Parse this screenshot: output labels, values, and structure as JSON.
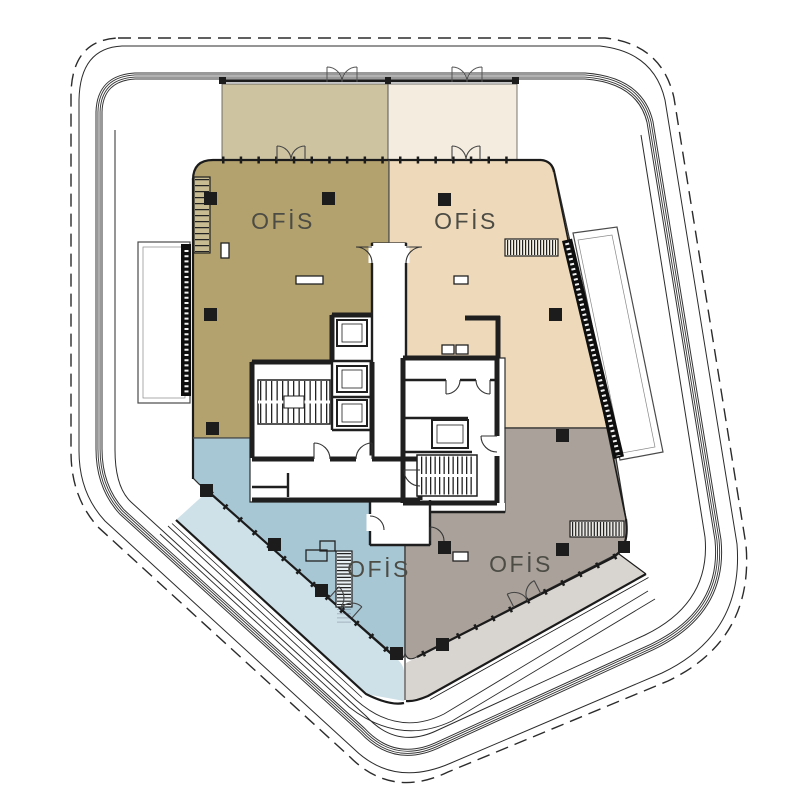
{
  "plan": {
    "zones": [
      {
        "name": "office-northwest",
        "label": "OFİS",
        "fill": "#b3a26e",
        "terrace_fill": "#cdc3a1"
      },
      {
        "name": "office-northeast",
        "label": "OFİS",
        "fill": "#eedabb",
        "terrace_fill": "#f4ecdf"
      },
      {
        "name": "office-southwest",
        "label": "OFİS",
        "fill": "#a8c7d5",
        "terrace_fill": "#cfe1e8"
      },
      {
        "name": "office-southeast",
        "label": "OFİS",
        "fill": "#a9a19a",
        "terrace_fill": "#d8d4cf"
      }
    ],
    "wall_color": "#1f1f1f",
    "site_line_color": "#2b2b2b",
    "label_color": "#4c4c45"
  }
}
